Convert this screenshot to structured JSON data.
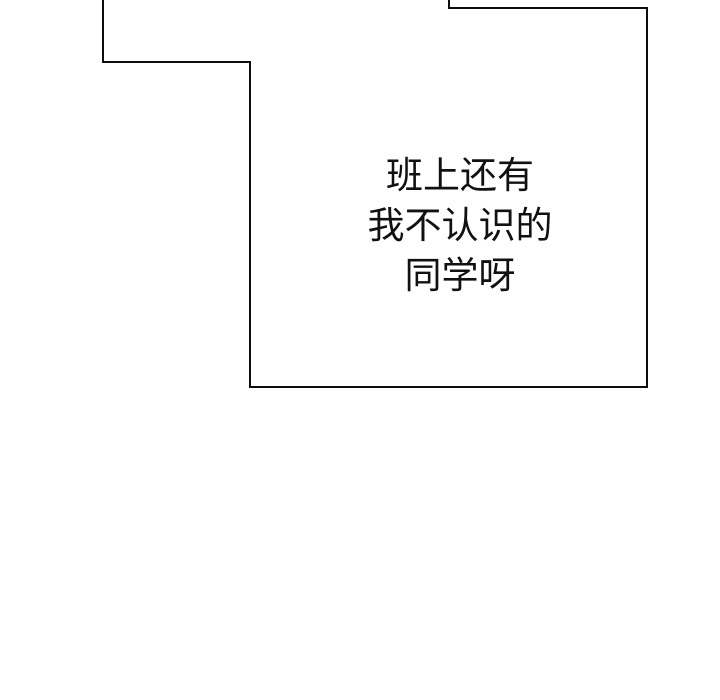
{
  "page": {
    "background_color": "#ffffff",
    "outline_color": "#0d0d0d",
    "text_color": "#111111"
  },
  "speech_bubble": {
    "lines": [
      "班上还有",
      "我不认识的",
      "同学呀"
    ],
    "full_text": "班上还有 我不认识的 同学呀"
  }
}
